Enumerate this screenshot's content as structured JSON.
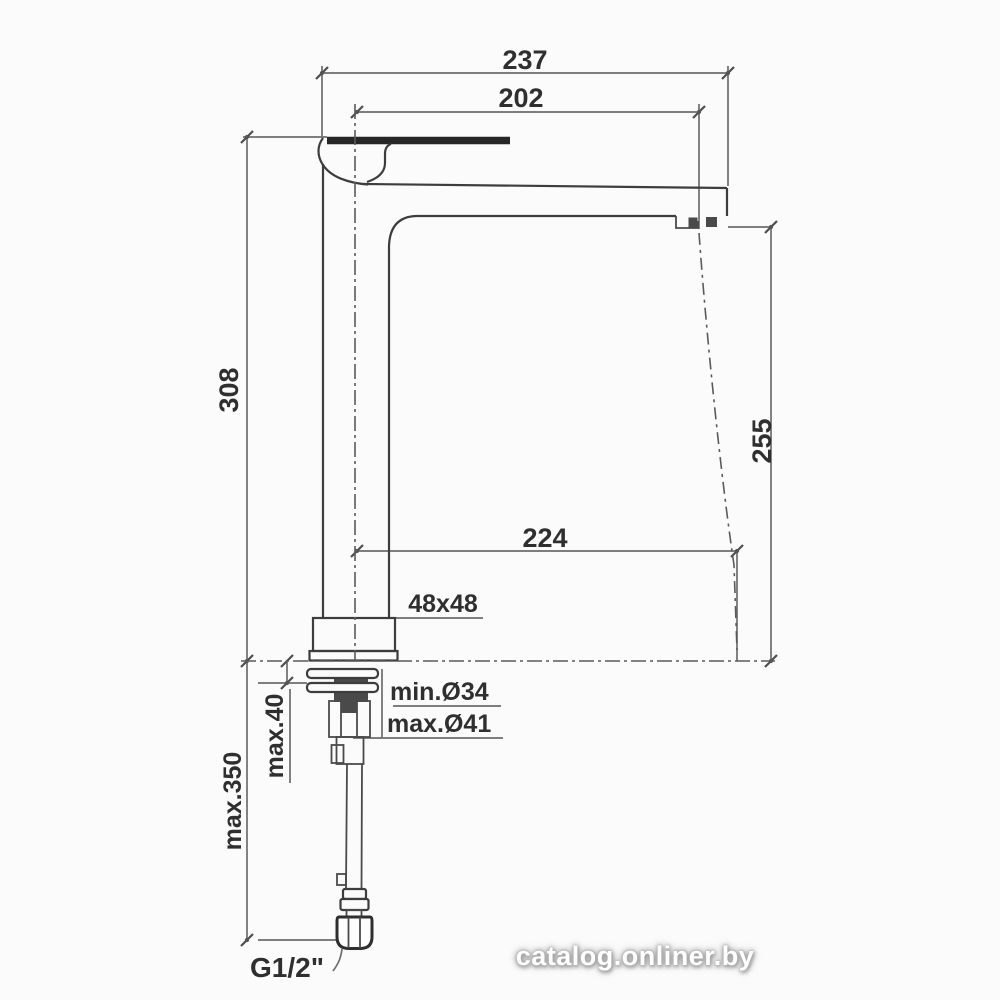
{
  "drawing": {
    "labels": {
      "overall_depth": "237",
      "spout_reach": "202",
      "height_to_top": "308",
      "spout_outlet_height": "255",
      "outlet_projection": "224",
      "base_section": "48x48",
      "hole_min_diameter": "min.Ø34",
      "hole_max_diameter": "max.Ø41",
      "deck_thickness_max": "max.40",
      "hose_length_max": "max.350",
      "connection_thread": "G1/2\""
    },
    "watermark": "catalog.onliner.by",
    "colors": {
      "object_line": "#3d3d3d",
      "dimension_line": "#6d6d6d",
      "centerline": "#5a5a5a",
      "text": "#2f2f2f",
      "background": "#fbfbfb",
      "watermark_text": "#ffffff",
      "watermark_glow": "#999999"
    }
  }
}
